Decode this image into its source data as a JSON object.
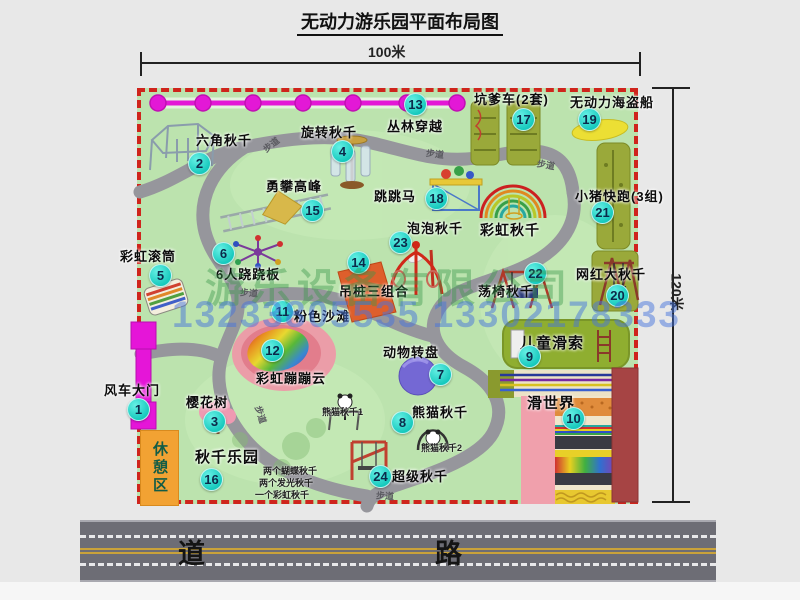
{
  "title": "无动力游乐园平面布局图",
  "dimensions": {
    "width": "100米",
    "height": "120米"
  },
  "road_label": "道    路",
  "path_label": "步道",
  "rest_area_label": "休憩区",
  "watermark": {
    "company": "游乐设备有限公司",
    "phone": "13233805535 13302178333"
  },
  "colors": {
    "map_green": "#bce3ae",
    "border_red": "#cf241c",
    "badge_teal": "#16c9bd",
    "gate_magenta": "#e515d8",
    "road_gray": "#6d6d75",
    "rest_orange": "#f2a233"
  },
  "items": [
    {
      "num": "1",
      "label": "风车大门"
    },
    {
      "num": "2",
      "label": "六角秋千"
    },
    {
      "num": "3",
      "label": "樱花树"
    },
    {
      "num": "4",
      "label": "旋转秋千"
    },
    {
      "num": "5",
      "label": "彩虹滚筒"
    },
    {
      "num": "6",
      "label": "6人跷跷板"
    },
    {
      "num": "7",
      "label": "动物转盘"
    },
    {
      "num": "8",
      "label": "熊猫秋千"
    },
    {
      "num": "9",
      "label": "儿童滑索"
    },
    {
      "num": "10",
      "label": "滑世界"
    },
    {
      "num": "11",
      "label": "粉色沙滩"
    },
    {
      "num": "12",
      "label": "彩虹蹦蹦云"
    },
    {
      "num": "13",
      "label": "丛林穿越"
    },
    {
      "num": "14",
      "label": "吊桩三组合"
    },
    {
      "num": "15",
      "label": "勇攀高峰"
    },
    {
      "num": "16",
      "label": "秋千乐园"
    },
    {
      "num": "17",
      "label": "坑爹车(2套)"
    },
    {
      "num": "18",
      "label": "跳跳马"
    },
    {
      "num": "19",
      "label": "无动力海盗船"
    },
    {
      "num": "20",
      "label": "网红大秋千"
    },
    {
      "num": "21",
      "label": "小猪快跑(3组)"
    },
    {
      "num": "22",
      "label": "荡椅秋千"
    },
    {
      "num": "23",
      "label": "泡泡秋千"
    },
    {
      "num": "24",
      "label": "超级秋千"
    }
  ],
  "extra_labels": {
    "rainbow_swing": "彩虹秋千",
    "swing_park_note1": "两个蝴蝶秋千",
    "swing_park_note2": "两个发光秋千",
    "swing_park_note3": "一个彩虹秋千",
    "panda_swing_1": "熊猫秋千1",
    "panda_swing_2": "熊猫秋千2"
  }
}
